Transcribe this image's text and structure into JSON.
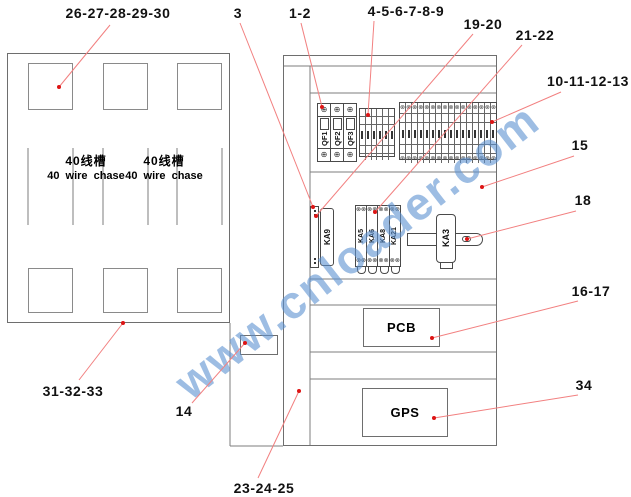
{
  "watermark": {
    "text": "www.cnloader.com",
    "color": "#5d92d1"
  },
  "left_panel": {
    "wire_chase_cn": "40线槽",
    "wire_chase_en": "40 wire chase"
  },
  "right_panel": {
    "breakers": [
      "QF1",
      "QF2",
      "QF3"
    ],
    "relay_left": "KA9",
    "relay_group": [
      "KA5",
      "KA6",
      "KA8",
      "KA21"
    ],
    "relay_din": "KA3",
    "pcb_label": "PCB",
    "gps_label": "GPS",
    "big_terminal_count": 16,
    "small_terminal_count": 6
  },
  "callouts": [
    {
      "label": "26-27-28-29-30",
      "lx": 118,
      "ly": 13,
      "x1": 110,
      "y1": 25,
      "x2": 59,
      "y2": 87
    },
    {
      "label": "3",
      "lx": 238,
      "ly": 13,
      "x1": 240,
      "y1": 23,
      "x2": 313,
      "y2": 207
    },
    {
      "label": "1-2",
      "lx": 300,
      "ly": 13,
      "x1": 301,
      "y1": 23,
      "x2": 322,
      "y2": 107
    },
    {
      "label": "4-5-6-7-8-9",
      "lx": 406,
      "ly": 11,
      "x1": 374,
      "y1": 21,
      "x2": 368,
      "y2": 115
    },
    {
      "label": "19-20",
      "lx": 483,
      "ly": 24,
      "x1": 473,
      "y1": 34,
      "x2": 316,
      "y2": 216
    },
    {
      "label": "21-22",
      "lx": 535,
      "ly": 35,
      "x1": 522,
      "y1": 45,
      "x2": 375,
      "y2": 212
    },
    {
      "label": "10-11-12-13",
      "lx": 588,
      "ly": 81,
      "x1": 561,
      "y1": 92,
      "x2": 492,
      "y2": 122
    },
    {
      "label": "15",
      "lx": 580,
      "ly": 145,
      "x1": 574,
      "y1": 156,
      "x2": 482,
      "y2": 187
    },
    {
      "label": "18",
      "lx": 583,
      "ly": 200,
      "x1": 576,
      "y1": 211,
      "x2": 467,
      "y2": 239
    },
    {
      "label": "16-17",
      "lx": 591,
      "ly": 291,
      "x1": 578,
      "y1": 301,
      "x2": 432,
      "y2": 338
    },
    {
      "label": "34",
      "lx": 584,
      "ly": 385,
      "x1": 578,
      "y1": 395,
      "x2": 434,
      "y2": 418
    },
    {
      "label": "31-32-33",
      "lx": 73,
      "ly": 391,
      "x1": 79,
      "y1": 380,
      "x2": 123,
      "y2": 323
    },
    {
      "label": "14",
      "lx": 184,
      "ly": 411,
      "x1": 192,
      "y1": 403,
      "x2": 245,
      "y2": 343
    },
    {
      "label": "23-24-25",
      "lx": 264,
      "ly": 488,
      "x1": 258,
      "y1": 478,
      "x2": 299,
      "y2": 391
    }
  ],
  "colors": {
    "structure_line": "#7d7d7d",
    "component_line": "#4a4a4a",
    "leader_line": "#f28080",
    "leader_dot": "#dd1414",
    "text": "#111111"
  }
}
